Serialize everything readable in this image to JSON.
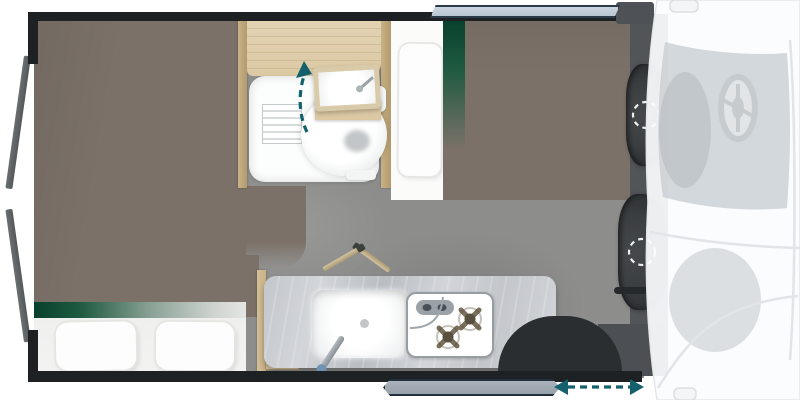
{
  "scene": {
    "type": "floorplan",
    "subject": "campervan-top-view",
    "areas": [
      "rear-bed",
      "bathroom",
      "kitchenette",
      "front-bench-bed",
      "driver-cab"
    ],
    "fixtures": [
      "rear-doors-open",
      "bed-pillows",
      "shower-tray",
      "shower-drain",
      "toilet",
      "swivel-sink",
      "kitchen-counter",
      "kitchen-sink",
      "kitchen-faucet",
      "two-burner-stove",
      "table-legs",
      "wheel-arch",
      "sliding-door",
      "top-window",
      "driver-seat",
      "passenger-seat",
      "steering-wheel",
      "side-mirrors"
    ],
    "icons": [
      "swivel-sink-arrow-icon",
      "sliding-door-arrow-icon",
      "seat-swivel-dashes-icon"
    ]
  },
  "colors": {
    "wall": "#1e2124",
    "bed": "#7b7168",
    "floor": "#8d8d8c",
    "green": "#07402c",
    "green2": "#1f5a41",
    "wood": "#dcc9a4",
    "wood-dark": "#c8b287",
    "mattress": "#f3f3f2",
    "pillow": "#fdfdfd",
    "bench": "#fbfbfa",
    "tray": "#fcfdfd",
    "drain": "#c2c6c9",
    "counter-a": "#c3c6ca",
    "counter-b": "#d2d5d9",
    "counter-c": "#b9bdc2",
    "steel": "#9aa2a8",
    "stove-frame": "#969da3",
    "burner": "#7a6f5b",
    "burner-dark": "#57503f",
    "arch": "#2b2e31",
    "cab-band": "#515459",
    "seat": "#3b3e41",
    "seat-dark": "#2a2d30",
    "teal": "#14616d",
    "window": "#b9c4d2",
    "window-frame": "#2c3b49",
    "door": "#97a1aa",
    "door-frame": "#22303d",
    "windshield": "#c9ced3",
    "cab-line": "#e2e5e7"
  }
}
